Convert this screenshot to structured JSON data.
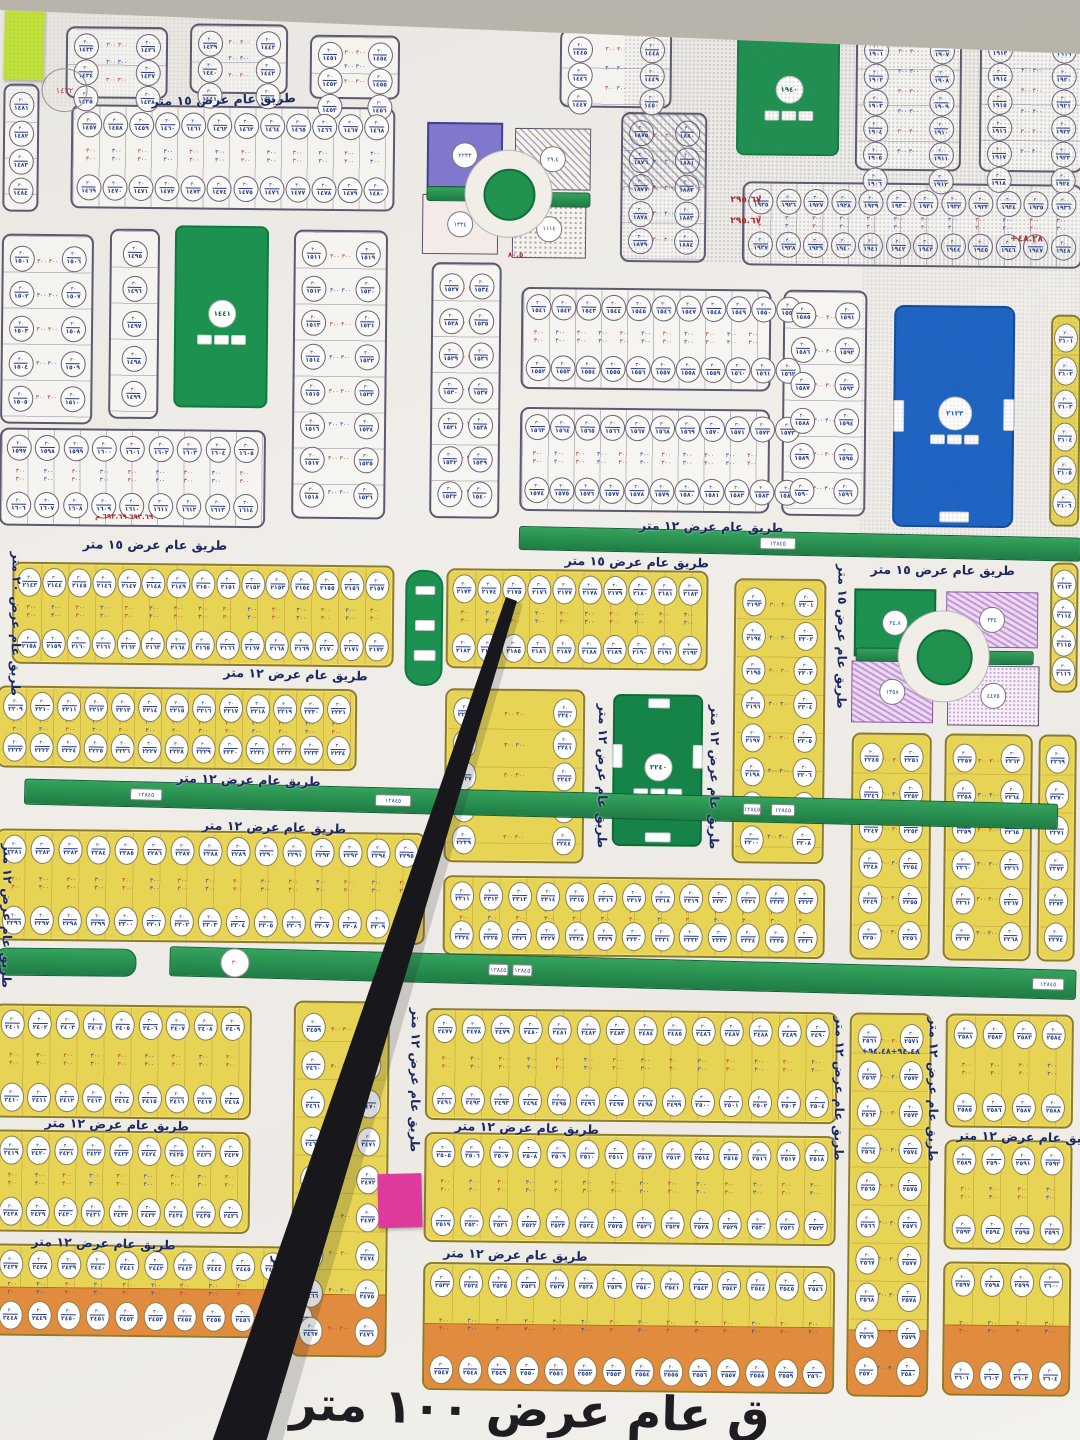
{
  "photo": {
    "subject": "municipal land subdivision plan poster (Arabic)",
    "wall_color": "#b0aba2",
    "paper_color": "#f0ede9"
  },
  "road_labels": {
    "w15": "طريق عام عرض ١٥ متر",
    "w12": "طريق عام عرض ١٢ متر",
    "w20": "طريق عام عرض ٢٠ متر"
  },
  "banner": {
    "text": "ق عام عرض ١٠٠ متر",
    "x": 300,
    "y": 1382,
    "fs": 47,
    "rot": 1
  },
  "digits": "٠١٢٣٤٥٦٧٨٩",
  "oval_top_text": "٣٠",
  "dim_text": "٣٠٠\n٣٠٠",
  "colors": {
    "yellow_block": "#e7d455",
    "orange_row": "#e08b3e",
    "park_green": "#1c9150",
    "facility_blue": "#1b63c4",
    "purple_plot": "#7f78cc",
    "road_text": "#1c2a60",
    "stick": "#18181c",
    "note_green": "#c2e23a",
    "note_pink": "#de3a9e"
  },
  "blocks": [
    {
      "x": 62,
      "y": 30,
      "w": 102,
      "h": 72,
      "kind": "wc",
      "rows": 3,
      "cols": 2,
      "start": 1433
    },
    {
      "x": 186,
      "y": 26,
      "w": 98,
      "h": 70,
      "kind": "wc",
      "rows": 3,
      "cols": 2,
      "start": 1439
    },
    {
      "x": 306,
      "y": 36,
      "w": 90,
      "h": 64,
      "kind": "wc",
      "rows": 3,
      "cols": 2,
      "start": 1451
    },
    {
      "x": 556,
      "y": 28,
      "w": 112,
      "h": 78,
      "kind": "wc",
      "rows": 3,
      "cols": 2,
      "start": 1445
    },
    {
      "x": 852,
      "y": 26,
      "w": 106,
      "h": 140,
      "kind": "wc",
      "rows": 6,
      "cols": 2,
      "start": 1901
    },
    {
      "x": 976,
      "y": 24,
      "w": 104,
      "h": 142,
      "kind": "wc",
      "rows": 6,
      "cols": 2,
      "start": 1913
    },
    {
      "x": 0,
      "y": 88,
      "w": 36,
      "h": 128,
      "kind": "wc",
      "rows": 4,
      "cols": 1,
      "start": 1481
    },
    {
      "x": 68,
      "y": 108,
      "w": 324,
      "h": 104,
      "kind": "wh",
      "cols": 12,
      "start": 1457
    },
    {
      "x": 618,
      "y": 110,
      "w": 86,
      "h": 150,
      "kind": "wc",
      "rows": 5,
      "cols": 2,
      "start": 1875,
      "hatch": true
    },
    {
      "x": 740,
      "y": 178,
      "w": 340,
      "h": 84,
      "kind": "wh",
      "cols": 12,
      "start": 1925
    },
    {
      "x": 0,
      "y": 238,
      "w": 92,
      "h": 190,
      "kind": "wc",
      "rows": 5,
      "cols": 2,
      "start": 1501
    },
    {
      "x": 108,
      "y": 232,
      "w": 50,
      "h": 190,
      "kind": "wc",
      "rows": 5,
      "cols": 1,
      "start": 1495
    },
    {
      "x": 292,
      "y": 231,
      "w": 94,
      "h": 289,
      "kind": "wc",
      "rows": 8,
      "cols": 2,
      "start": 1511
    },
    {
      "x": 430,
      "y": 262,
      "w": 70,
      "h": 256,
      "kind": "wc",
      "rows": 7,
      "cols": 2,
      "start": 1527
    },
    {
      "x": 520,
      "y": 286,
      "w": 250,
      "h": 102,
      "kind": "wh",
      "cols": 11,
      "start": 1541
    },
    {
      "x": 520,
      "y": 406,
      "w": 250,
      "h": 104,
      "kind": "wh",
      "cols": 11,
      "start": 1563
    },
    {
      "x": 782,
      "y": 286,
      "w": 84,
      "h": 226,
      "kind": "wc",
      "rows": 6,
      "cols": 2,
      "start": 1585
    },
    {
      "x": 0,
      "y": 432,
      "w": 266,
      "h": 98,
      "kind": "wh",
      "cols": 9,
      "start": 1597
    },
    {
      "x": 1050,
      "y": 308,
      "w": 30,
      "h": 212,
      "kind": "yc",
      "rows": 6,
      "cols": 1,
      "start": 2101
    },
    {
      "x": 1052,
      "y": 556,
      "w": 28,
      "h": 130,
      "kind": "yc",
      "rows": 4,
      "cols": 1,
      "start": 2113
    },
    {
      "x": 14,
      "y": 566,
      "w": 382,
      "h": 102,
      "kind": "yh",
      "cols": 15,
      "start": 2143
    },
    {
      "x": 448,
      "y": 568,
      "w": 262,
      "h": 100,
      "kind": "yh",
      "cols": 10,
      "start": 2173
    },
    {
      "x": 736,
      "y": 575,
      "w": 92,
      "h": 285,
      "kind": "yc",
      "rows": 8,
      "cols": 2,
      "start": 2193
    },
    {
      "x": 0,
      "y": 690,
      "w": 360,
      "h": 82,
      "kind": "yh",
      "cols": 13,
      "start": 2209
    },
    {
      "x": 448,
      "y": 688,
      "w": 140,
      "h": 174,
      "kind": "yc",
      "rows": 5,
      "cols": 2,
      "start": 2235
    },
    {
      "x": 855,
      "y": 728,
      "w": 80,
      "h": 227,
      "kind": "yc",
      "rows": 6,
      "cols": 2,
      "start": 2245
    },
    {
      "x": 948,
      "y": 728,
      "w": 88,
      "h": 227,
      "kind": "yc",
      "rows": 6,
      "cols": 2,
      "start": 2257
    },
    {
      "x": 1042,
      "y": 728,
      "w": 38,
      "h": 227,
      "kind": "yc",
      "rows": 6,
      "cols": 1,
      "start": 2269
    },
    {
      "x": 0,
      "y": 833,
      "w": 430,
      "h": 112,
      "kind": "yh",
      "cols": 15,
      "start": 2281
    },
    {
      "x": 448,
      "y": 875,
      "w": 382,
      "h": 80,
      "kind": "yh",
      "cols": 13,
      "start": 2311
    },
    {
      "x": 0,
      "y": 1008,
      "w": 258,
      "h": 114,
      "kind": "yh",
      "cols": 9,
      "start": 2401
    },
    {
      "x": 0,
      "y": 1134,
      "w": 258,
      "h": 102,
      "kind": "yh",
      "cols": 9,
      "start": 2419
    },
    {
      "x": 0,
      "y": 1248,
      "w": 330,
      "h": 92,
      "kind": "yo",
      "cols": 11,
      "start": 2437
    },
    {
      "x": 300,
      "y": 1002,
      "w": 96,
      "h": 356,
      "kind": "yc",
      "rows": 9,
      "cols": 2,
      "start": 2459,
      "orange": 60
    },
    {
      "x": 432,
      "y": 1008,
      "w": 412,
      "h": 112,
      "kind": "yh",
      "cols": 14,
      "start": 2477
    },
    {
      "x": 432,
      "y": 1132,
      "w": 412,
      "h": 110,
      "kind": "yh",
      "cols": 14,
      "start": 2505
    },
    {
      "x": 432,
      "y": 1262,
      "w": 412,
      "h": 128,
      "kind": "yo",
      "cols": 14,
      "start": 2533
    },
    {
      "x": 856,
      "y": 1008,
      "w": 82,
      "h": 384,
      "kind": "yc",
      "rows": 10,
      "cols": 2,
      "start": 2561,
      "orange": 64
    },
    {
      "x": 952,
      "y": 1008,
      "w": 128,
      "h": 114,
      "kind": "yh",
      "cols": 4,
      "start": 2581
    },
    {
      "x": 952,
      "y": 1134,
      "w": 128,
      "h": 110,
      "kind": "yh",
      "cols": 4,
      "start": 2589
    },
    {
      "x": 952,
      "y": 1256,
      "w": 128,
      "h": 134,
      "kind": "yo",
      "cols": 4,
      "start": 2597
    }
  ],
  "parks": [
    {
      "x": 173,
      "y": 228,
      "w": 90,
      "h": 178,
      "type": "green",
      "chip": "١٤٤١"
    },
    {
      "x": 733,
      "y": 26,
      "w": 99,
      "h": 122,
      "type": "green",
      "chip": "١٩٤٠"
    },
    {
      "x": 893,
      "y": 300,
      "w": 117,
      "h": 218,
      "type": "blue",
      "chip": "٢١٢٣"
    },
    {
      "x": 616,
      "y": 692,
      "w": 86,
      "h": 148,
      "type": "green2",
      "chip": "٢٢٤٠"
    },
    {
      "x": 407,
      "y": 570,
      "w": 34,
      "h": 112,
      "type": "pill",
      "chip": ""
    }
  ],
  "roundabouts": [
    {
      "cx": 505,
      "cy": 192,
      "ring": 43,
      "core": 24
    },
    {
      "cx": 945,
      "cy": 650,
      "ring": 45,
      "core": 26
    }
  ],
  "specials": [
    {
      "type": "purple",
      "x": 424,
      "y": 122,
      "w": 72,
      "h": 62,
      "cut": "br",
      "chip": "٢٢٣٣"
    },
    {
      "type": "hatch",
      "x": 512,
      "y": 127,
      "w": 74,
      "h": 60,
      "cut": "bl",
      "chip": "٢٩.٤"
    },
    {
      "type": "plain",
      "x": 420,
      "y": 194,
      "w": 74,
      "h": 58,
      "cut": "tr",
      "chip": "١٣٣٤"
    },
    {
      "type": "dots",
      "x": 510,
      "y": 198,
      "w": 72,
      "h": 57,
      "cut": "tl",
      "chip": "١١١٤"
    },
    {
      "type": "green",
      "x": 856,
      "y": 584,
      "w": 78,
      "h": 64,
      "cut": "br",
      "chip": "٢٤.٨"
    },
    {
      "type": "phatch",
      "x": 948,
      "y": 586,
      "w": 90,
      "h": 54,
      "cut": "bl",
      "chip": "٣٣٤"
    },
    {
      "type": "phatch",
      "x": 854,
      "y": 656,
      "w": 80,
      "h": 60,
      "cut": "tr",
      "chip": "١٣٥٨"
    },
    {
      "type": "pdots",
      "x": 950,
      "y": 660,
      "w": 90,
      "h": 58,
      "cut": "tl",
      "chip": "٤٤٧٥"
    }
  ],
  "strips": [
    {
      "x": 424,
      "y": 186,
      "w": 64,
      "h": 13,
      "rot": 0,
      "chips": []
    },
    {
      "x": 522,
      "y": 191,
      "w": 64,
      "h": 13,
      "rot": 0,
      "chips": []
    },
    {
      "x": 520,
      "y": 528,
      "w": 560,
      "h": 22,
      "rot": 0.6,
      "chips": [
        [
          240,
          34
        ]
      ]
    },
    {
      "x": 28,
      "y": 790,
      "w": 1032,
      "h": 24,
      "rot": 0.8,
      "chips": [
        [
          105,
          30
        ],
        [
          350,
          34
        ],
        [
          718,
          16
        ],
        [
          746,
          22
        ]
      ]
    },
    {
      "x": 0,
      "y": 952,
      "w": 140,
      "h": 26,
      "rot": 0,
      "round": true,
      "chips": []
    },
    {
      "x": 175,
      "y": 956,
      "w": 905,
      "h": 28,
      "rot": 0.9,
      "chips": [
        [
          318,
          18
        ],
        [
          342,
          18
        ],
        [
          862,
          30
        ]
      ],
      "circle": 50
    },
    {
      "x": 858,
      "y": 643,
      "w": 58,
      "h": 12,
      "rot": 0,
      "chips": []
    },
    {
      "x": 982,
      "y": 645,
      "w": 52,
      "h": 12,
      "rot": 0,
      "chips": []
    }
  ],
  "labels": [
    {
      "x": 148,
      "y": 94,
      "rot": -2,
      "key": "w15"
    },
    {
      "x": 640,
      "y": 516,
      "rot": 0.5,
      "key": "w12"
    },
    {
      "x": 566,
      "y": 552,
      "rot": 0.5,
      "key": "w15"
    },
    {
      "x": 84,
      "y": 540,
      "rot": 0,
      "key": "w15"
    },
    {
      "x": 872,
      "y": 557,
      "rot": 0,
      "key": "w15"
    },
    {
      "x": 226,
      "y": 668,
      "rot": 1,
      "key": "w12"
    },
    {
      "x": 180,
      "y": 774,
      "rot": 1,
      "key": "w12"
    },
    {
      "x": 206,
      "y": 821,
      "rot": 1,
      "key": "w12"
    },
    {
      "x": 52,
      "y": 1120,
      "rot": 1,
      "key": "w12"
    },
    {
      "x": 462,
      "y": 1119,
      "rot": 1,
      "key": "w12"
    },
    {
      "x": 964,
      "y": 1123,
      "rot": 1,
      "key": "w12"
    },
    {
      "x": 452,
      "y": 1246,
      "rot": 1,
      "key": "w12"
    },
    {
      "x": 40,
      "y": 1239,
      "rot": 1,
      "key": "w12"
    }
  ],
  "vlabels": [
    {
      "x": 26,
      "y": 556,
      "key": "w20"
    },
    {
      "x": 20,
      "y": 848,
      "key": "w12"
    },
    {
      "x": 852,
      "y": 560,
      "key": "w15"
    },
    {
      "x": 614,
      "y": 702,
      "key": "w12"
    },
    {
      "x": 726,
      "y": 702,
      "key": "w12"
    },
    {
      "x": 430,
      "y": 1008,
      "key": "w12"
    },
    {
      "x": 854,
      "y": 1012,
      "key": "w12"
    },
    {
      "x": 948,
      "y": 1012,
      "key": "w12"
    },
    {
      "x": 294,
      "y": 1258,
      "key": "w12"
    }
  ],
  "stamps": [
    {
      "x": 38,
      "y": 72,
      "type": "circle",
      "text": "١٤٣٢"
    },
    {
      "x": 728,
      "y": 192,
      "type": "text",
      "text": "٢٩٥.٦٧",
      "color": "#b02828",
      "fs": 9
    },
    {
      "x": 728,
      "y": 213,
      "type": "text",
      "text": "٢٩٥.٦٧",
      "color": "#b02828",
      "fs": 9
    },
    {
      "x": 1008,
      "y": 228,
      "type": "text",
      "text": "+٤٨.٢٨",
      "color": "#b02828",
      "fs": 9
    },
    {
      "x": 868,
      "y": 1042,
      "type": "text",
      "text": "+٩٤.٤٨+٩٤.٤٨",
      "color": "#203a9a",
      "fs": 8
    },
    {
      "x": 96,
      "y": 516,
      "type": "text",
      "text": "٦٩٣.٦٩ ٦٩٣.٦٩ م",
      "color": "#b02828",
      "fs": 7
    },
    {
      "x": 506,
      "y": 250,
      "type": "text",
      "text": "٨٠.٥",
      "color": "#b02828",
      "fs": 7
    }
  ],
  "notes": [
    {
      "x": 0,
      "y": 12,
      "w": 40,
      "h": 72,
      "color": "#c2e23a",
      "rot": 1,
      "name": "green-sticky-note"
    },
    {
      "x": 386,
      "y": 1174,
      "w": 44,
      "h": 54,
      "color": "#de3a9e",
      "rot": -2,
      "name": "pink-sticky-note"
    }
  ],
  "stick": {
    "points": "506,597 517,601 266,1442 212,1442",
    "shadow": "512,600 523,604 282,1442 258,1442",
    "color": "#18181c"
  },
  "glares": [
    {
      "x": 620,
      "y": 0,
      "w": 460,
      "h": 260,
      "op": 0.45
    },
    {
      "x": 860,
      "y": 230,
      "w": 220,
      "h": 300,
      "op": 0.28
    },
    {
      "x": 0,
      "y": 0,
      "w": 260,
      "h": 110,
      "op": 0.22
    }
  ]
}
